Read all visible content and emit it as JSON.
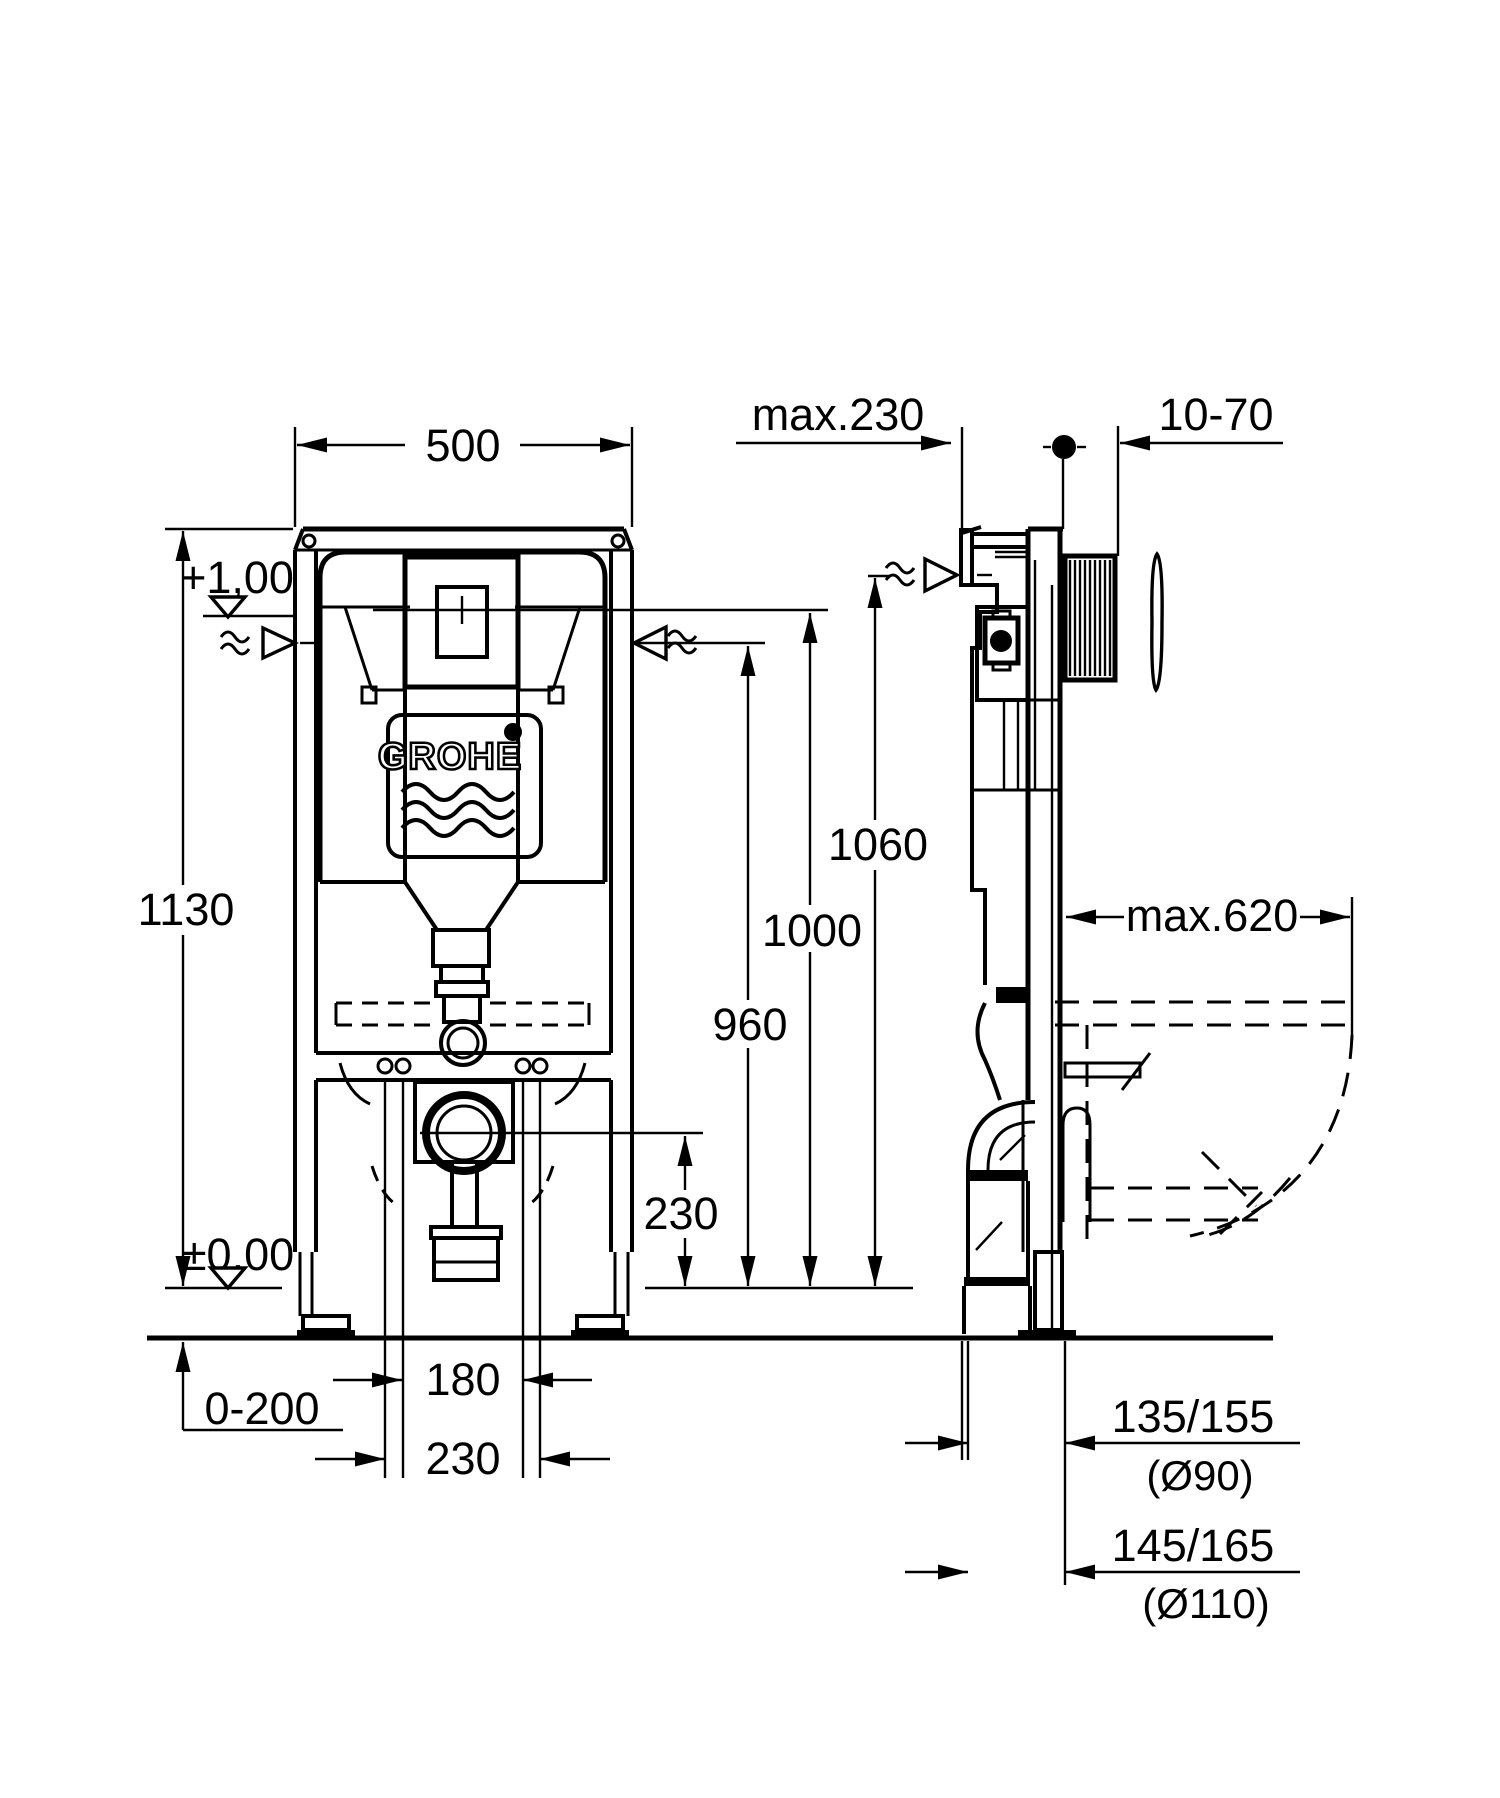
{
  "drawing": {
    "brand_logo": "GROHE",
    "colors": {
      "line": "#000000",
      "background": "#ffffff"
    },
    "front_view": {
      "frame_width": "500",
      "frame_height": "1130",
      "level_upper": "+1,00",
      "level_zero": "±0,00",
      "feet_adjust_range": "0-200",
      "supply_height": "960",
      "actuator_height": "1000",
      "top_edge_height": "1060",
      "drain_center_height": "230",
      "bolt_spacing_inner": "180",
      "bolt_spacing_outer": "230"
    },
    "side_view": {
      "depth_max": "max.230",
      "wall_finish_range": "10-70",
      "bowl_projection_max": "max.620",
      "drain_offset_small": "135/155",
      "drain_offset_small_pipe": "(Ø90)",
      "drain_offset_large": "145/165",
      "drain_offset_large_pipe": "(Ø110)"
    }
  }
}
